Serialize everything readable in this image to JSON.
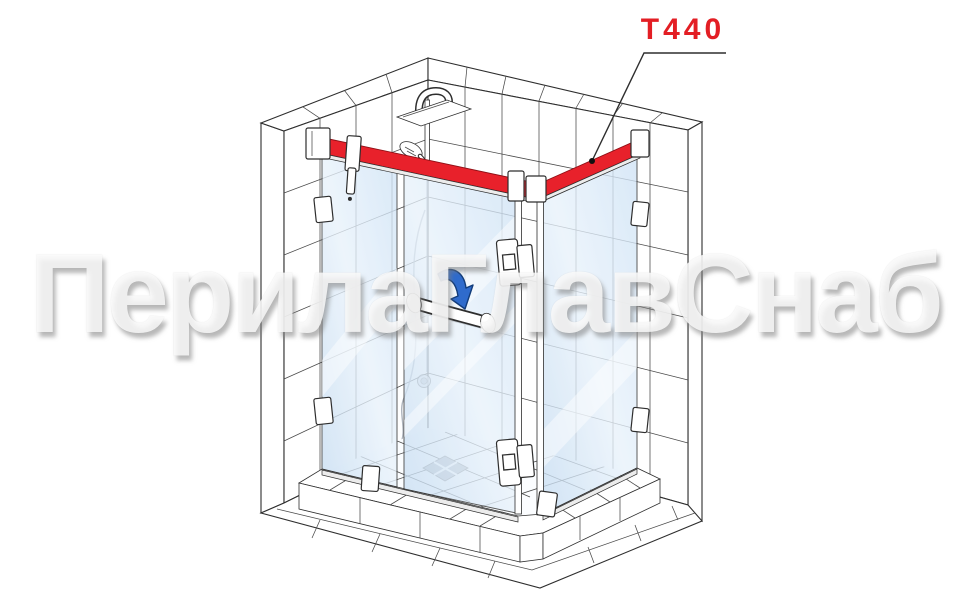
{
  "watermark": {
    "text": "ПерилаГлавСнаб"
  },
  "callout": {
    "label": "T440"
  },
  "colors": {
    "label-red": "#e31e24",
    "accent-red": "#e8212b",
    "accent-red-dark": "#8f1016",
    "glass-blue": "#cfe2f6",
    "glass-blue-light": "#eaf3fc",
    "arrow-blue": "#2f6bcc",
    "arrow-blue-dark": "#123c7a",
    "line-dark": "#2e2e2e",
    "tile-line": "#4a4a4a",
    "drain-gray": "#aeb4bc"
  },
  "illustration": {
    "subject": "Corner shower enclosure with hinged glass door, isometric technical drawing",
    "highlighted_part": "top stabilization bar highlighted in red, labeled T440",
    "elements": [
      "tiled walls",
      "rain shower head",
      "hand shower",
      "left fixed glass panel",
      "hinged glass door",
      "right fixed glass panel",
      "corner hinges",
      "door handle",
      "door swing arrow",
      "wall mounting brackets",
      "stabilization bar",
      "tiled curb",
      "floor drain",
      "floor tiles"
    ]
  }
}
